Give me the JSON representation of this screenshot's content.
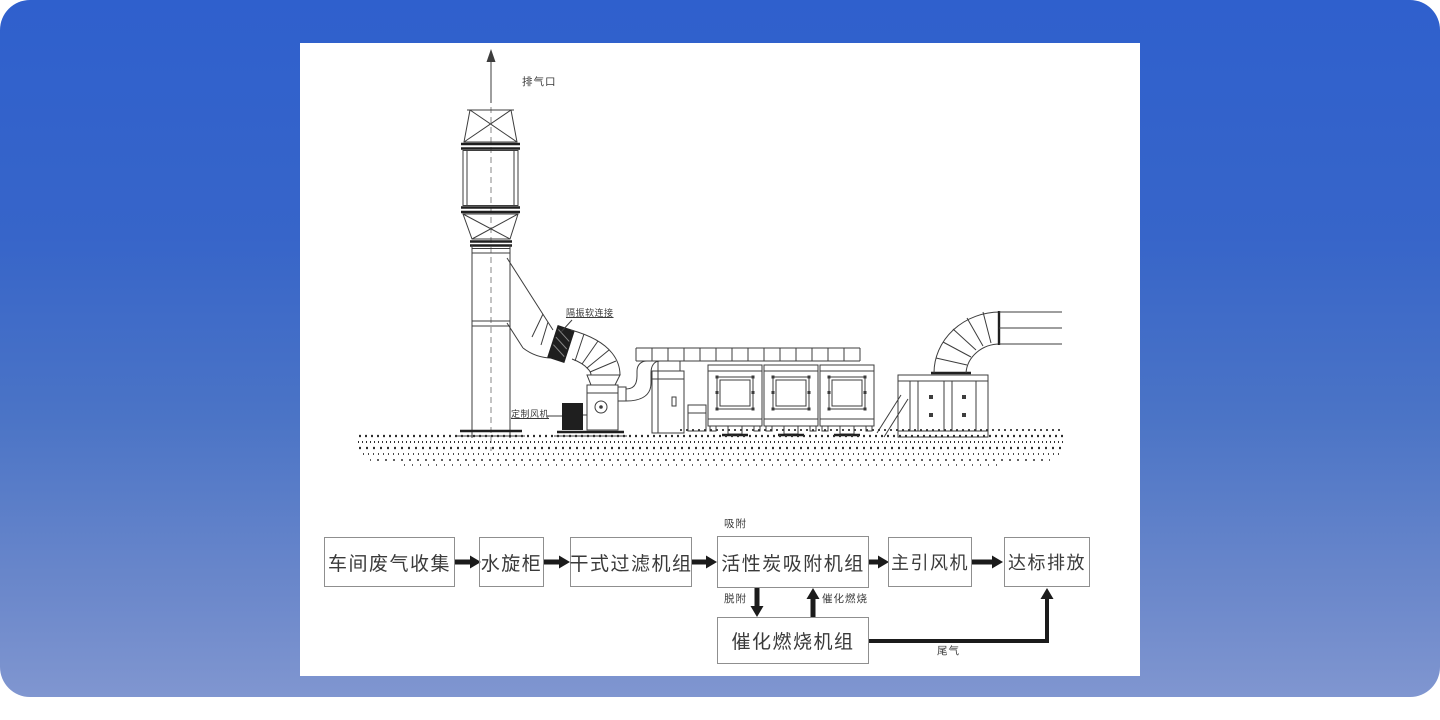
{
  "colors": {
    "bg_top": "#2f60cd",
    "bg_mid": "#4b74c6",
    "bg_bottom": "#8096d0",
    "panel_bg": "#ffffff",
    "line": "#3d3d3d",
    "box_border": "#8f8f8f",
    "box_text": "#3a3a3a",
    "arrow": "#1b1b1b"
  },
  "drawing": {
    "labels": {
      "exhaust_outlet": "排气口",
      "vibration_flex_connection": "隔振软连接",
      "custom_fan": "定制风机"
    }
  },
  "flowchart": {
    "boxes": [
      {
        "label": "车间废气收集"
      },
      {
        "label": "水旋柜"
      },
      {
        "label": "干式过滤机组"
      },
      {
        "label": "活性炭吸附机组"
      },
      {
        "label": "主引风机"
      },
      {
        "label": "达标排放"
      },
      {
        "label": "催化燃烧机组"
      }
    ],
    "annotations": {
      "adsorption": "吸附",
      "desorption": "脱附",
      "catalytic_combustion": "催化燃烧",
      "tail_gas": "尾气"
    }
  }
}
